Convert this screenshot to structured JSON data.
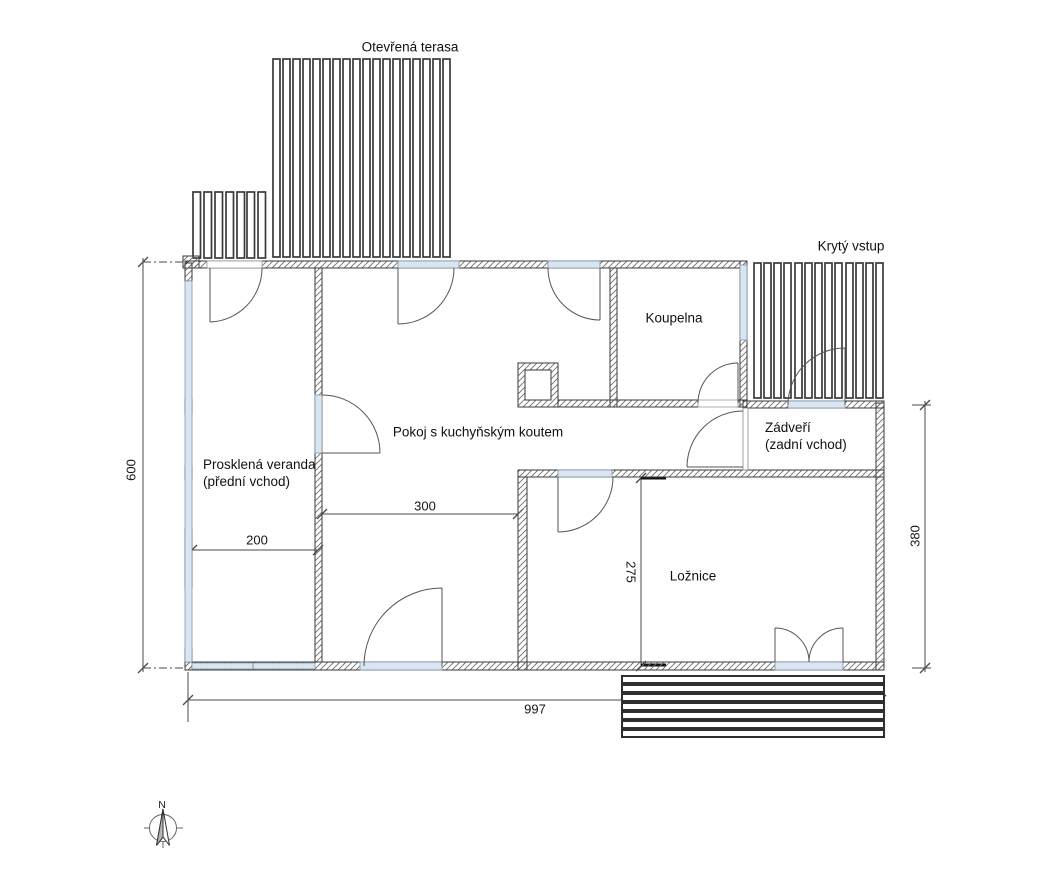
{
  "outdoor_areas": [
    {
      "name": "Otevřená terasa"
    },
    {
      "name": "Krytý vstup"
    }
  ],
  "rooms": [
    {
      "name": "Prosklená veranda",
      "subtitle": "(přední vchod)"
    },
    {
      "name": "Pokoj s kuchyňským koutem",
      "subtitle": ""
    },
    {
      "name": "Koupelna",
      "subtitle": ""
    },
    {
      "name": "Zádveří",
      "subtitle": "(zadní vchod)"
    },
    {
      "name": "Ložnice",
      "subtitle": ""
    }
  ],
  "dimensions": {
    "total_width": "997",
    "left_height": "600",
    "right_height": "380",
    "veranda_width": "200",
    "living_width": "300",
    "bedroom_depth": "275"
  },
  "compass": {
    "north": "N"
  },
  "colors": {
    "glazing": "#d9e6f2",
    "wall_line": "#3a3a3a",
    "hatch_line": "#6e6e6e",
    "dimension_line": "#4a4a4a"
  }
}
